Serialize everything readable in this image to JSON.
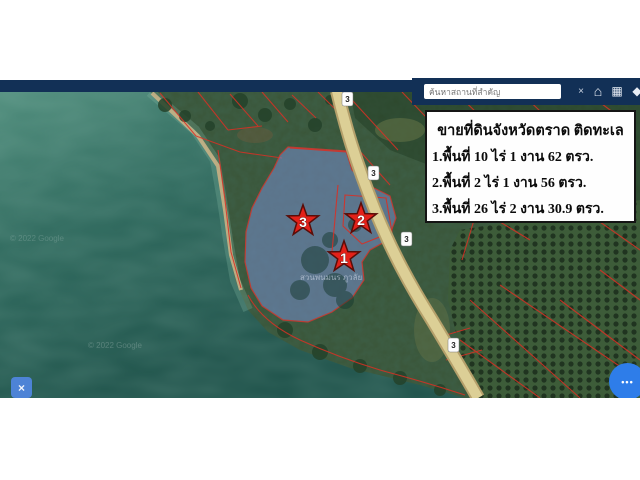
{
  "toolbar": {
    "search_placeholder": "ค้นหาสถานที่สำคัญ",
    "clear_label": "×",
    "icons": {
      "home": "⌂",
      "grid": "▦",
      "layers": "◆"
    }
  },
  "info_box": {
    "title": "ขายที่ดินจังหวัดตราด ติดทะเล",
    "lines": [
      "1.พื้นที่ 10 ไร่ 1 งาน 62 ตรว.",
      "2.พื้นที่ 2 ไร่ 1 งาน 56 ตรว.",
      "3.พื้นที่ 26 ไร่ 2 งาน 30.9 ตรว."
    ]
  },
  "map": {
    "markers": [
      {
        "label": "1"
      },
      {
        "label": "2"
      },
      {
        "label": "3"
      }
    ],
    "route_shield": "3",
    "watermark": "© 2022 Google",
    "place_label": "สวนพนมนร ภูวลัย",
    "colors": {
      "sea": "#2a6458",
      "land": "#3a5538",
      "parcel_highlight": "#7b90d4",
      "cadastral_line": "#d93025",
      "star": "#e32119",
      "navy_bar": "#123056",
      "road": "#d6c489",
      "chat_bubble": "#2e7de9"
    }
  },
  "widgets": {
    "chat_dots": "•••",
    "draw_tool_glyph": "×"
  }
}
